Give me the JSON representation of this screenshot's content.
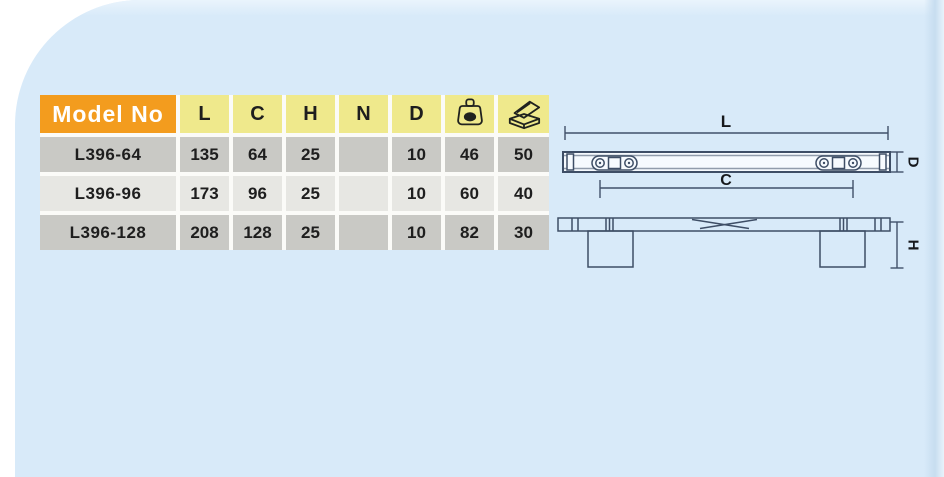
{
  "table": {
    "header": {
      "model_label": "Model No",
      "columns": [
        "L",
        "C",
        "H",
        "N",
        "D"
      ],
      "icons": {
        "weight": "weight-icon",
        "box": "packing-box-icon"
      }
    },
    "rows": [
      {
        "model": "L396-64",
        "values": [
          "135",
          "64",
          "25",
          "",
          "10",
          "46",
          "50"
        ]
      },
      {
        "model": "L396-96",
        "values": [
          "173",
          "96",
          "25",
          "",
          "10",
          "60",
          "40"
        ]
      },
      {
        "model": "L396-128",
        "values": [
          "208",
          "128",
          "25",
          "",
          "10",
          "82",
          "30"
        ]
      }
    ]
  },
  "diagram": {
    "labels": {
      "length": "L",
      "centers": "C",
      "depth": "D",
      "height": "H"
    }
  },
  "colors": {
    "panel_blue": "#d8eaf9",
    "header_orange": "#f39c1e",
    "header_yellow": "#efe98c",
    "row_dark": "#c9c9c5",
    "row_light": "#e7e7e3",
    "drawing_line": "#3e4e66",
    "text_dark": "#1e1e1e"
  }
}
